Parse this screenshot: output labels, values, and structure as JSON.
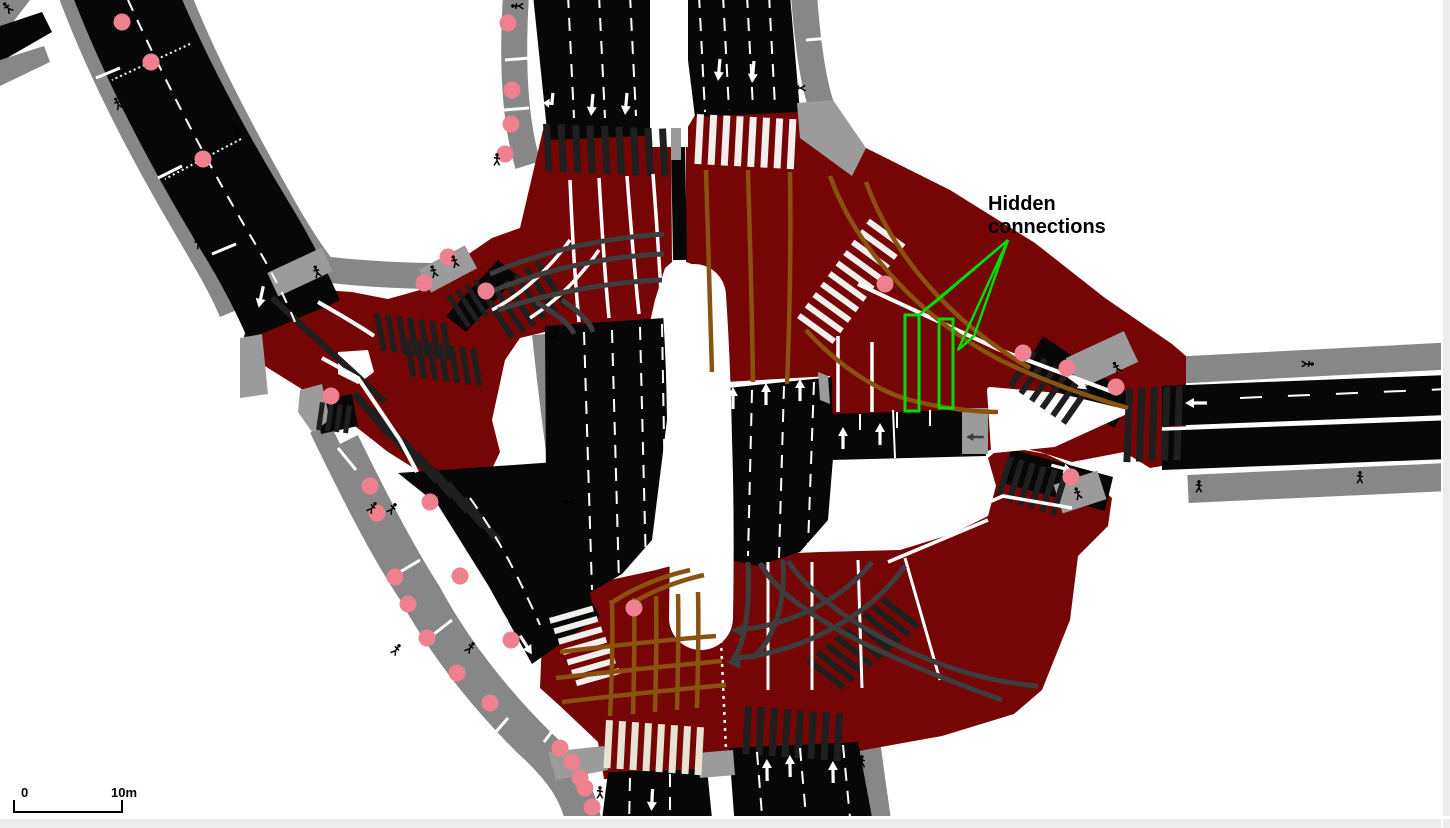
{
  "annotation": {
    "line1": "Hidden",
    "line2": "connections",
    "color": "#00dd00",
    "text_color": "#000000"
  },
  "scale_bar": {
    "start_label": "0",
    "end_label": "10m"
  },
  "colors": {
    "canvas_background": "#ffffff",
    "junction_fill": "#760606",
    "road_fill": "#070707",
    "sidewalk_gray": "#878787",
    "walkingarea_gray": "#9b9b9b",
    "connection_brown": "#8a5210",
    "connection_gray": "#3d3d3d",
    "junction_marker_pink": "#ef8090",
    "crosswalk_white": "#f1f0ec",
    "crosswalk_cream": "#e7e3d2",
    "crossing_dark": "#1f1f1f",
    "lane_marking_white": "#ffffff",
    "annotation_green": "#00dd00",
    "window_chrome_gray": "#ececec"
  },
  "icons": {
    "pedestrian_icon": "walking-person",
    "junction_point_icon": "pink-circle",
    "lane_arrow_icon": "white-arrow"
  },
  "junction_markers": [
    [
      122,
      22
    ],
    [
      151,
      62
    ],
    [
      203,
      159
    ],
    [
      508,
      23
    ],
    [
      512,
      90
    ],
    [
      511,
      124
    ],
    [
      505,
      154
    ],
    [
      448,
      257
    ],
    [
      424,
      283
    ],
    [
      486,
      291
    ],
    [
      331,
      396
    ],
    [
      370,
      486
    ],
    [
      377,
      513
    ],
    [
      430,
      502
    ],
    [
      460,
      576
    ],
    [
      395,
      577
    ],
    [
      408,
      604
    ],
    [
      427,
      638
    ],
    [
      511,
      640
    ],
    [
      457,
      673
    ],
    [
      490,
      703
    ],
    [
      560,
      748
    ],
    [
      572,
      762
    ],
    [
      580,
      778
    ],
    [
      585,
      788
    ],
    [
      592,
      807
    ],
    [
      634,
      608
    ],
    [
      885,
      284
    ],
    [
      1023,
      353
    ],
    [
      1067,
      368
    ],
    [
      1116,
      387
    ],
    [
      1071,
      477
    ]
  ],
  "pedestrian_icons": [
    [
      8,
      8,
      -40
    ],
    [
      118,
      104,
      -25
    ],
    [
      237,
      131,
      -25
    ],
    [
      198,
      243,
      -25
    ],
    [
      317,
      272,
      -20
    ],
    [
      434,
      272,
      -20
    ],
    [
      455,
      262,
      -20
    ],
    [
      518,
      6,
      -90
    ],
    [
      497,
      160,
      0
    ],
    [
      800,
      88,
      -90
    ],
    [
      553,
      337,
      -90
    ],
    [
      569,
      502,
      -90
    ],
    [
      372,
      508,
      35
    ],
    [
      392,
      509,
      35
    ],
    [
      396,
      650,
      35
    ],
    [
      470,
      648,
      35
    ],
    [
      600,
      793,
      0
    ],
    [
      862,
      762,
      0
    ],
    [
      1117,
      368,
      -30
    ],
    [
      1078,
      494,
      -20
    ],
    [
      1199,
      487,
      0
    ],
    [
      1307,
      364,
      90
    ],
    [
      1360,
      478,
      0
    ]
  ]
}
